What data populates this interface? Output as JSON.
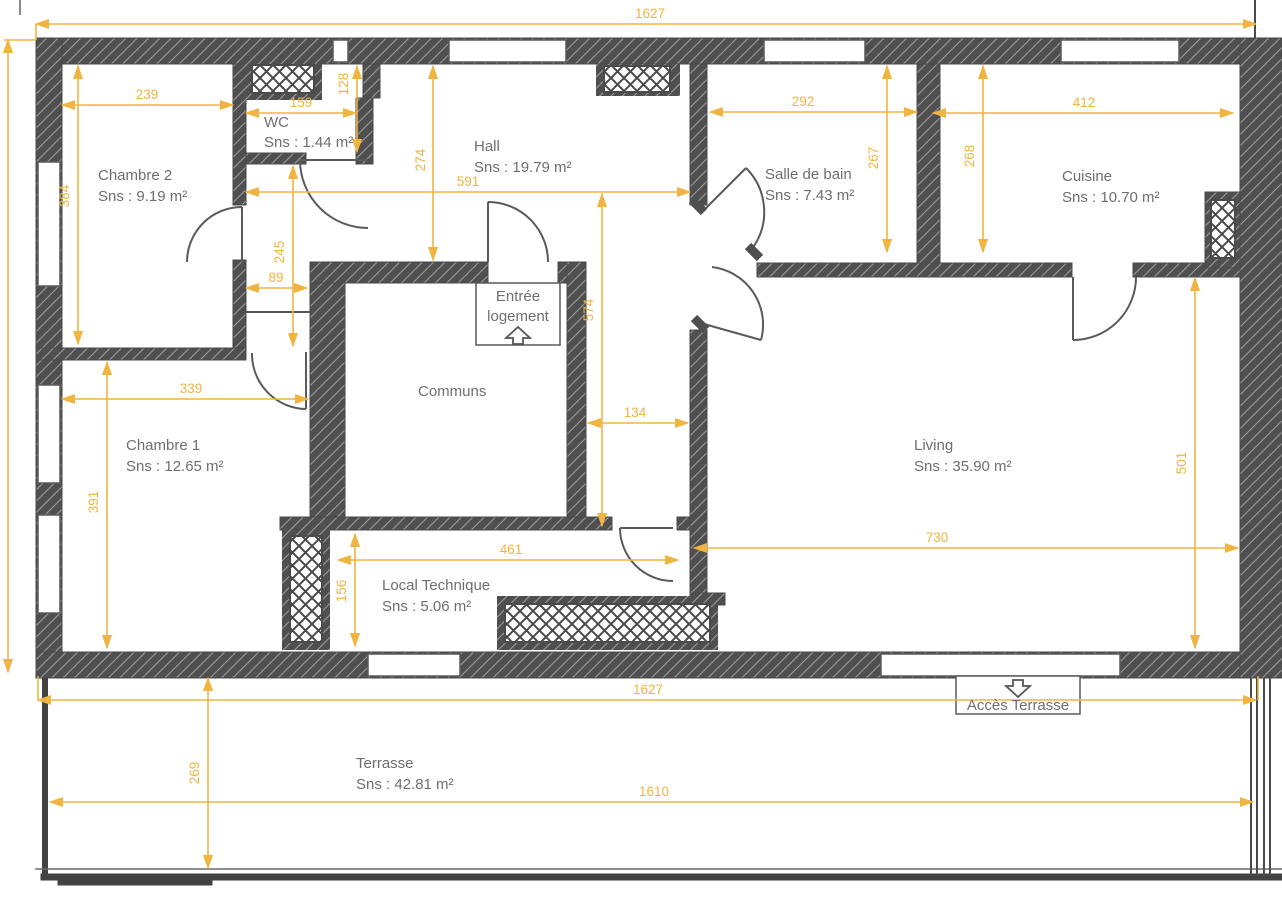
{
  "plan": {
    "rooms": {
      "chambre2": {
        "name": "Chambre 2",
        "area": "Sns : 9.19 m²"
      },
      "wc": {
        "name": "WC",
        "area": "Sns : 1.44 m²"
      },
      "hall": {
        "name": "Hall",
        "area": "Sns : 19.79 m²"
      },
      "salle_de_bain": {
        "name": "Salle de bain",
        "area": "Sns : 7.43 m²"
      },
      "cuisine": {
        "name": "Cuisine",
        "area": "Sns : 10.70 m²"
      },
      "communs": {
        "name": "Communs",
        "area": ""
      },
      "chambre1": {
        "name": "Chambre 1",
        "area": "Sns : 12.65 m²"
      },
      "living": {
        "name": "Living",
        "area": "Sns : 35.90 m²"
      },
      "local_technique": {
        "name": "Local Technique",
        "area": "Sns : 5.06 m²"
      },
      "terrasse": {
        "name": "Terrasse",
        "area": "Sns : 42.81 m²"
      }
    },
    "labels": {
      "entree_line1": "Entrée",
      "entree_line2": "logement",
      "acces_terrasse": "Accès Terrasse"
    },
    "dimensions_cm": {
      "top_total": "1627",
      "bottom_total": "1627",
      "terrace_width": "1610",
      "terrace_depth": "269",
      "chambre2_width": "239",
      "chambre2_height": "384",
      "wc_width": "159",
      "wc_height": "128",
      "hall_height": "274",
      "hall_width": "591",
      "hall_corridor": "574",
      "corridor_width": "134",
      "sdb_width": "292",
      "sdb_height": "267",
      "cuisine_height": "268",
      "cuisine_width": "412",
      "ch2_inner": "245",
      "niche": "89",
      "chambre1_width": "339",
      "chambre1_height": "391",
      "local_width": "461",
      "local_height": "156",
      "living_width": "730",
      "living_height": "501"
    },
    "colors": {
      "dimension": "#F0B441",
      "wall": "#4F4F4F",
      "room_text": "#6E6E6E",
      "line": "#555555"
    }
  }
}
